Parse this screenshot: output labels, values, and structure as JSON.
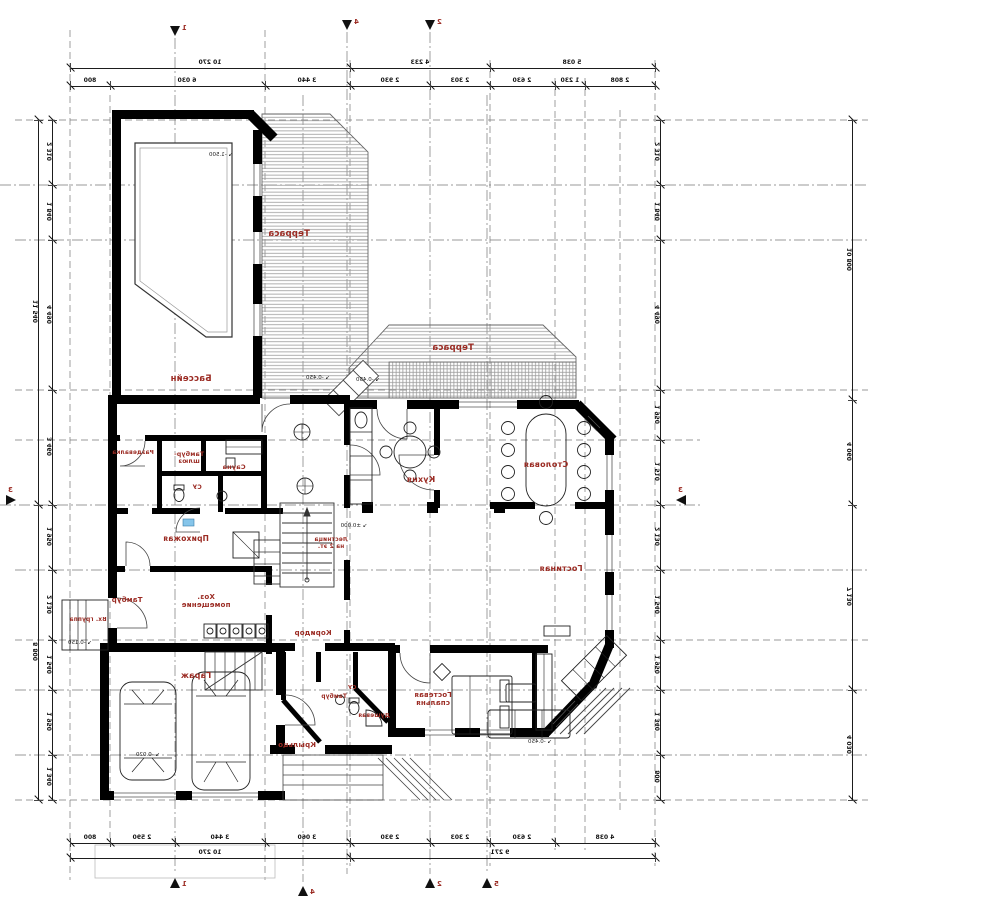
{
  "drawing": {
    "kind": "mirrored architectural ground-floor plan",
    "colors": {
      "wall": "#000000",
      "label_red": "#9b2b23",
      "hatch": "#8a8a8a",
      "axis": "#666666",
      "window_blue": "#86c5ea"
    }
  },
  "rooms": [
    {
      "name": "Бассейн",
      "x": 191,
      "y": 381,
      "size": 8.5
    },
    {
      "name": "Терраса",
      "x": 289,
      "y": 236,
      "size": 8.5
    },
    {
      "name": "Терраса",
      "x": 453,
      "y": 350,
      "size": 8.5
    },
    {
      "name": "Раздевалка",
      "x": 133,
      "y": 456,
      "size": 5.8
    },
    {
      "name": "Тамбур-\nшлюз",
      "x": 189,
      "y": 457,
      "size": 6.2
    },
    {
      "name": "Сауна",
      "x": 234,
      "y": 470,
      "size": 6.5
    },
    {
      "name": "СУ",
      "x": 197,
      "y": 491,
      "size": 6
    },
    {
      "name": "Кухня",
      "x": 421,
      "y": 481,
      "size": 8
    },
    {
      "name": "Столовая",
      "x": 546,
      "y": 466,
      "size": 8
    },
    {
      "name": "Прихожая",
      "x": 186,
      "y": 541,
      "size": 7.5
    },
    {
      "name": "Лестница\nна 2 эт.",
      "x": 331,
      "y": 543,
      "size": 5.8
    },
    {
      "name": "Тамбур",
      "x": 127,
      "y": 602,
      "size": 7
    },
    {
      "name": "Хоз.\nпомещение",
      "x": 206,
      "y": 599,
      "size": 7
    },
    {
      "name": "Гостиная",
      "x": 561,
      "y": 570,
      "size": 8
    },
    {
      "name": "Коридор",
      "x": 313,
      "y": 635,
      "size": 7
    },
    {
      "name": "Вх. группа",
      "x": 88,
      "y": 623,
      "size": 5.8
    },
    {
      "name": "Гараж",
      "x": 196,
      "y": 677,
      "size": 8
    },
    {
      "name": "Тамбур",
      "x": 334,
      "y": 700,
      "size": 5.8
    },
    {
      "name": "СУ",
      "x": 352,
      "y": 691,
      "size": 5.5
    },
    {
      "name": "Душевая",
      "x": 374,
      "y": 719,
      "size": 5.8
    },
    {
      "name": "Гостевая\nспальня",
      "x": 433,
      "y": 697,
      "size": 7
    },
    {
      "name": "Крыльцо",
      "x": 297,
      "y": 747,
      "size": 7
    }
  ],
  "level_marks": [
    {
      "text": "-1.500",
      "x": 221,
      "y": 156
    },
    {
      "text": "-0.450",
      "x": 318,
      "y": 379
    },
    {
      "text": "-0.450",
      "x": 368,
      "y": 381
    },
    {
      "text": "±0.000",
      "x": 354,
      "y": 527
    },
    {
      "text": "-0.020",
      "x": 148,
      "y": 756
    },
    {
      "text": "-0.450",
      "x": 540,
      "y": 743
    },
    {
      "text": "-0.150",
      "x": 80,
      "y": 644
    }
  ],
  "dimensions": {
    "chains": [
      {
        "id": "top-outer",
        "dir": "h",
        "y": 68,
        "x1": 70,
        "x2": 655,
        "ticks": [
          70,
          350,
          490,
          655
        ],
        "labels": [
          {
            "t": "10 270",
            "p": 210
          },
          {
            "t": "4 233",
            "p": 420
          },
          {
            "t": "5 038",
            "p": 572
          }
        ]
      },
      {
        "id": "top-inner",
        "dir": "h",
        "y": 86,
        "x1": 70,
        "x2": 655,
        "ticks": [
          70,
          110,
          265,
          350,
          430,
          490,
          555,
          585,
          655
        ],
        "labels": [
          {
            "t": "800",
            "p": 90
          },
          {
            "t": "6 030",
            "p": 187
          },
          {
            "t": "3 440",
            "p": 307
          },
          {
            "t": "2 930",
            "p": 390
          },
          {
            "t": "2 303",
            "p": 460
          },
          {
            "t": "2 630",
            "p": 522
          },
          {
            "t": "1 230",
            "p": 570
          },
          {
            "t": "2 808",
            "p": 620
          }
        ]
      },
      {
        "id": "bottom-inner",
        "dir": "h",
        "y": 843,
        "x1": 70,
        "x2": 655,
        "ticks": [
          70,
          110,
          175,
          265,
          350,
          430,
          490,
          555,
          655
        ],
        "labels": [
          {
            "t": "800",
            "p": 90
          },
          {
            "t": "2 590",
            "p": 142
          },
          {
            "t": "3 440",
            "p": 220
          },
          {
            "t": "3 060",
            "p": 307
          },
          {
            "t": "2 930",
            "p": 390
          },
          {
            "t": "2 303",
            "p": 460
          },
          {
            "t": "2 630",
            "p": 522
          },
          {
            "t": "4 038",
            "p": 605
          }
        ]
      },
      {
        "id": "bottom-outer",
        "dir": "h",
        "y": 858,
        "x1": 70,
        "x2": 655,
        "ticks": [
          70,
          350,
          655
        ],
        "labels": [
          {
            "t": "10 270",
            "p": 210
          },
          {
            "t": "9 271",
            "p": 500
          }
        ]
      },
      {
        "id": "left-inner",
        "dir": "v",
        "x": 52,
        "y1": 120,
        "y2": 800,
        "ticks": [
          120,
          185,
          240,
          390,
          505,
          570,
          640,
          690,
          755,
          800
        ],
        "labels": [
          {
            "t": "2 310",
            "p": 152
          },
          {
            "t": "1 840",
            "p": 212
          },
          {
            "t": "4 490",
            "p": 315
          },
          {
            "t": "3 460",
            "p": 447
          },
          {
            "t": "1 950",
            "p": 537
          },
          {
            "t": "2 130",
            "p": 605
          },
          {
            "t": "1 540",
            "p": 665
          },
          {
            "t": "1 950",
            "p": 722
          },
          {
            "t": "1 340",
            "p": 777
          }
        ]
      },
      {
        "id": "left-outer",
        "dir": "v",
        "x": 38,
        "y1": 120,
        "y2": 800,
        "ticks": [
          120,
          505,
          800
        ],
        "labels": [
          {
            "t": "11 540",
            "p": 312
          },
          {
            "t": "8 800",
            "p": 652
          }
        ]
      },
      {
        "id": "right-inner",
        "dir": "v",
        "x": 660,
        "y1": 120,
        "y2": 800,
        "ticks": [
          120,
          185,
          240,
          390,
          440,
          505,
          570,
          640,
          690,
          755,
          800
        ],
        "labels": [
          {
            "t": "2 310",
            "p": 152
          },
          {
            "t": "1 840",
            "p": 212
          },
          {
            "t": "4 490",
            "p": 315
          },
          {
            "t": "1 950",
            "p": 415
          },
          {
            "t": "1 510",
            "p": 472
          },
          {
            "t": "2 130",
            "p": 537
          },
          {
            "t": "1 540",
            "p": 605
          },
          {
            "t": "1 950",
            "p": 665
          },
          {
            "t": "1 340",
            "p": 722
          },
          {
            "t": "800",
            "p": 777
          }
        ]
      },
      {
        "id": "right-outer",
        "dir": "v",
        "x": 852,
        "y1": 120,
        "y2": 800,
        "ticks": [
          120,
          400,
          505,
          690,
          800
        ],
        "labels": [
          {
            "t": "10 800",
            "p": 260
          },
          {
            "t": "4 060",
            "p": 452
          },
          {
            "t": "7 130",
            "p": 597
          },
          {
            "t": "4 030",
            "p": 745
          }
        ]
      }
    ]
  },
  "section_markers": [
    {
      "x": 175,
      "y": 26,
      "dir": "down",
      "label": "1"
    },
    {
      "x": 347,
      "y": 20,
      "dir": "down",
      "label": "4"
    },
    {
      "x": 430,
      "y": 20,
      "dir": "down",
      "label": "2"
    },
    {
      "x": 175,
      "y": 878,
      "dir": "up",
      "label": "1"
    },
    {
      "x": 303,
      "y": 886,
      "dir": "up",
      "label": "4"
    },
    {
      "x": 430,
      "y": 878,
      "dir": "up",
      "label": "2"
    },
    {
      "x": 487,
      "y": 878,
      "dir": "up",
      "label": "5"
    },
    {
      "x": 6,
      "y": 500,
      "dir": "right",
      "label": "3"
    },
    {
      "x": 676,
      "y": 500,
      "dir": "left",
      "label": "3"
    }
  ]
}
